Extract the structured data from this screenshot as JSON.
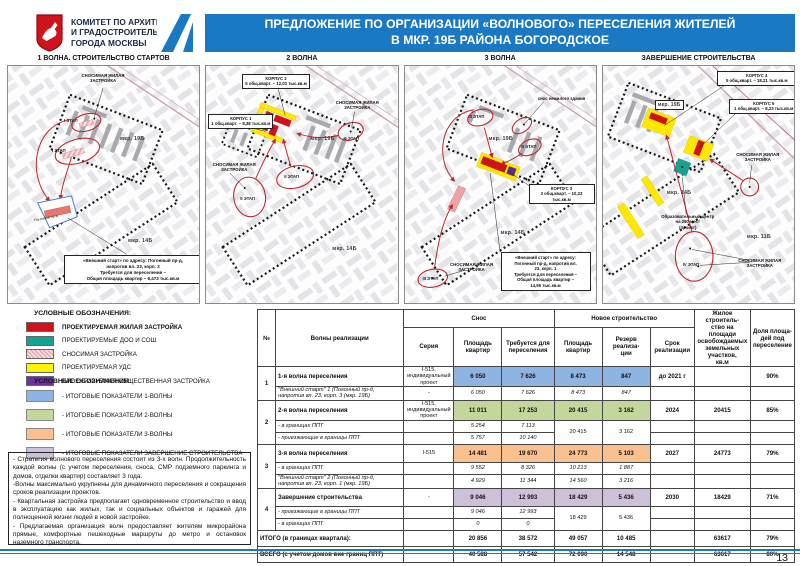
{
  "header": {
    "org": "КОМИТЕТ ПО АРХИТЕКТУРЕ\nИ ГРАДОСТРОИТЕЛЬСТВУ\nГОРОДА МОСКВЫ",
    "title_line1": "ПРЕДЛОЖЕНИЕ ПО ОРГАНИЗАЦИИ «ВОЛНОВОГО» ПЕРЕСЕЛЕНИЯ ЖИТЕЛЕЙ",
    "title_line2": "В  МКР. 19Б РАЙОНА  БОГОРОДСКОЕ"
  },
  "maps": {
    "panel1": {
      "title": "1 ВОЛНА. СТРОИТЕЛЬСТВО СТАРТОВ",
      "demolish": "СНОСИМАЯ ЖИЛАЯ\nЗАСТРОЙКА",
      "stage_a": "I ЭТАП",
      "stage_b": "I ЭТАП",
      "site": "Погонный пр-д",
      "mkr19": "мкр. 19Б",
      "mkr14": "мкр. 14Б",
      "callout": "«Внешний старт» по адресу: Погонный пр-д,\nнапротив вл. 23, корп. 3\nТребуется для переселения –\nОбщая площадь квартир – 8,473 тыс.кв.м"
    },
    "panel2": {
      "title": "2 ВОЛНА",
      "korpus2": "КОРПУС 2\n5 общ.кварт. – 12,03 тыс.кв.м",
      "korpus1": "КОРПУС 1\n1 общ.кварт. – 8,38 тыс.кв.м",
      "demolish_l": "СНОСИМАЯ ЖИЛАЯ\nЗАСТРОЙКА",
      "demolish_r": "СНОСИМАЯ ЖИЛАЯ\nЗАСТРОЙКА",
      "stage_a": "II ЭТАП",
      "stage_b": "II ЭТАП",
      "stage_c": "II ЭТАП",
      "mkr19": "мкр. 19Б",
      "mkr14": "мкр. 14Б"
    },
    "panel3": {
      "title": "3 ВОЛНА",
      "nonres": "снос нежилого здания",
      "korpus3": "КОРПУС 3\n3 общ.кварт. – 10,23 тыс.кв.м",
      "stage_a": "III ЭТАП",
      "stage_c": "III ЭТАП",
      "stage_d": "III ЭТАП",
      "demolish": "СНОСИМАЯ ЖИЛАЯ\nЗАСТРОЙКА",
      "mkr19": "мкр. 19Б",
      "mkr14": "мкр. 14Б",
      "callout": "«Внешний старт» по адресу:\nПогонный пр-д, напротив вл.\n23, корп. 1\nТребуется для переселения –\nОбщая площадь квартир –\n14,56 тыс.кв.м"
    },
    "panel4": {
      "title": "ЗАВЕРШЕНИЕ СТРОИТЕЛЬСТВА",
      "korpus4": "КОРПУС 4\n5 общ.кварт. – 18,21 тыс.кв.м",
      "korpus5": "КОРПУС 5\n1 общ.кварт. – 8,23 тыс.кв.м",
      "edu": "Образовательный центр\nна 250 мест\n(проект)",
      "stage": "IV ЭТАП",
      "demolish_r": "СНОСИМАЯ ЖИЛАЯ\nЗАСТРОЙКА",
      "demolish_b": "СНОСИМАЯ ЖИЛАЯ\nЗАСТРОЙКА",
      "mkr19": "мкр. 19Б",
      "mkr14": "мкр. 14Б",
      "mkr11": "мкр. 11Б"
    }
  },
  "legend_zones": {
    "title": "УСЛОВНЫЕ ОБОЗНАЧЕНИЯ:",
    "items": [
      {
        "label": "ПРОЕКТИРУЕМАЯ ЖИЛАЯ ЗАСТРОЙКА",
        "color": "#d0131b"
      },
      {
        "label": "ПРОЕКТИРУЕМЫЕ ДОО И СОШ",
        "color": "#17a28f"
      },
      {
        "label": "СНОСИМАЯ ЗАСТРОЙКА",
        "color": "#eba7ad"
      },
      {
        "label": "ПРОЕКТИРУЕМАЯ УДС",
        "color": "#fff200"
      },
      {
        "label": "ПРОЕКТИРУЕМАЯ ОБЩЕСТВЕННАЯ ЗАСТРОЙКА",
        "color": "#7030a0"
      }
    ]
  },
  "legend_waves": {
    "title": "УСЛОВНЫЕ ОБОЗНАЧЕНИЯ:",
    "items": [
      {
        "label": "- ИТОГОВЫЕ ПОКАЗАТЕЛИ 1-ВОЛНЫ",
        "color": "#8db4e2"
      },
      {
        "label": "- ИТОГОВЫЕ ПОКАЗАТЕЛИ 2-ВОЛНЫ",
        "color": "#c3d69b"
      },
      {
        "label": "- ИТОГОВЫЕ ПОКАЗАТЕЛИ 3-ВОЛНЫ",
        "color": "#fac090"
      },
      {
        "label": "- ИТОГОВЫЕ ПОКАЗАТЕЛИ ЗАВЕРШЕНИЕ СТРОИТЕЛЬСТВА",
        "color": "#ccc1d9"
      }
    ]
  },
  "notes": {
    "p1": "- Стратегия волнового переселения состоит из 3-х волн. Продолжительность каждой волны  (с учетом переселения, сноса, СМР подземного паркинга и домов, отделки квартир) составляет 3 года.",
    "p2": "-Волны максимально укрупнены для динамичного переселения и сокращения сроков реализации проектов.",
    "p3": "- Квартальная застройка предполагает одновременное строительство и ввод в эксплуатацию как жилых, так и социальных объектов и гаражей для полноценной жизни людей в новой застройке.",
    "p4": "- Предлагаемая организация волн предоставляет жителям микрорайона прямые, комфортные пешеходные маршруты до метро и остановок наземного транспорта."
  },
  "table": {
    "header": {
      "num": "№",
      "waves": "Волны реализации",
      "snos": "Снос",
      "novoe": "Новое строительство",
      "seriya": "Серия",
      "pk1": "Площадь\nквартир",
      "treb": "Требуется для\nпереселения",
      "pk2": "Площадь\nквартир",
      "rezerv": "Резерв реализа-\nции",
      "srok": "Срок\nреализации",
      "zhil": "Жилое строитель-\nство на площади\nосвобождаемых\nземельных участков,\nкв.м",
      "dolya": "Доля площа-\nдей под\nпереселение"
    },
    "body": [
      {
        "num": "1",
        "name": "1-я волна переселения",
        "seriya": "I-515,\nиндивидуальный\nпроект",
        "c1": "6 050",
        "c2": "7 626",
        "c3": "8 473",
        "c4": "847",
        "srok": "до 2021 г",
        "zhil": "",
        "dolya": "90%"
      },
      {
        "name": "\"Внешний старт\" 1 (Погонный пр-д,\nнапротив вл. 23, корп. 3 (мкр. 19Б)",
        "seriya": "-",
        "c1": "6 050",
        "c2": "7 626",
        "c3": "8 473",
        "c4": "847"
      },
      {
        "num": "2",
        "name": "2-я волна переселения",
        "seriya": "I-515,\nиндивидуальный\nпроект",
        "c1": "11 011",
        "c2": "17 253",
        "c3": "20 415",
        "c4": "3 162",
        "srok": "2024",
        "zhil": "20415",
        "dolya": "85%"
      },
      {
        "name": "- в границах ППТ",
        "c1": "5 254",
        "c2": "7 113",
        "c3": "20 415",
        "c4": "3 162"
      },
      {
        "name": "- приезжающие в границы ППТ",
        "c1": "5 757",
        "c2": "10 140"
      },
      {
        "num": "3",
        "name": "3-я волна переселения",
        "seriya": "I-515",
        "c1": "14 481",
        "c2": "19 670",
        "c3": "24 773",
        "c4": "5 103",
        "srok": "2027",
        "zhil": "24773",
        "dolya": "79%"
      },
      {
        "name": "- в границах ППТ",
        "c1": "9 552",
        "c2": "8 326",
        "c3": "10 213",
        "c4": "1 887"
      },
      {
        "name": "\"Внешний старт\" 2 (Погонный пр-д,\nнапротив вл. 23, корп. 1 (мкр. 19Б)",
        "c1": "4 929",
        "c2": "11 344",
        "c3": "14 560",
        "c4": "3 216"
      },
      {
        "num": "4",
        "name": "Завершение строительства",
        "seriya": "-",
        "c1": "9 046",
        "c2": "12 993",
        "c3": "18 429",
        "c4": "5 436",
        "srok": "2030",
        "zhil": "18429",
        "dolya": "71%"
      },
      {
        "name": "- приезжающие в границы ППТ",
        "c1": "9 046",
        "c2": "12 993",
        "c3": "18 429",
        "c4": "5 436"
      },
      {
        "name": "- в границах ППТ",
        "c1": "0",
        "c2": "0"
      },
      {
        "label": "ИТОГО (в границах квартала):",
        "c1": "20 856",
        "c2": "38 572",
        "c3": "49 057",
        "c4": "10 485",
        "srok": "",
        "zhil": "63617",
        "dolya": "79%"
      },
      {
        "label": "ВСЕГО (с учетом домов вне границ ППТ)",
        "c1": "40 588",
        "c2": "57 542",
        "c3": "72 090",
        "c4": "14 548",
        "srok": "",
        "zhil": "63617",
        "dolya": "80%"
      }
    ]
  },
  "footer": {
    "page": "13"
  },
  "colors": {
    "accent_blue": "#1b78c2",
    "table_blue": "#8db4e2",
    "table_green": "#c3d69b",
    "table_orange": "#fac090",
    "table_purple": "#ccc1d9",
    "map_red": "#c0272d",
    "legend_red": "#d0131b",
    "legend_teal": "#17a28f",
    "legend_yellow": "#fff200",
    "legend_purple": "#7030a0"
  }
}
